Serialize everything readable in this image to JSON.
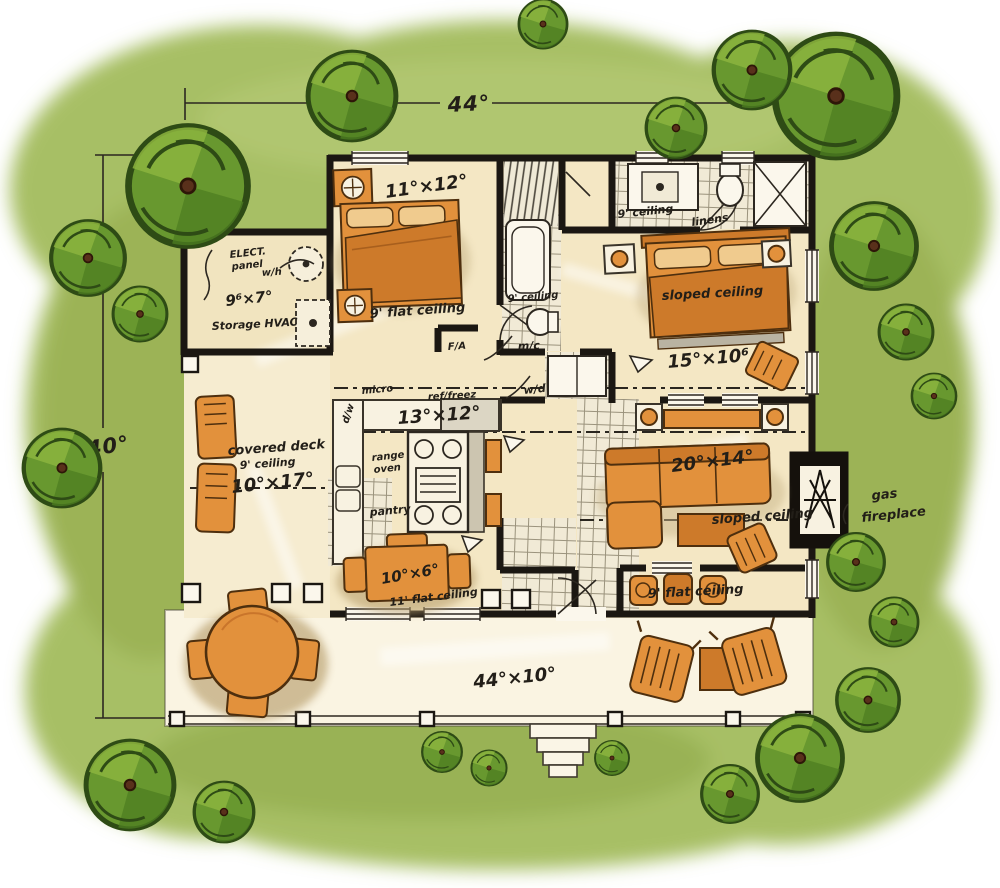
{
  "title": "hand-drawn cottage floor plan",
  "colors": {
    "ground_green": "#a7bf65",
    "tree_green": "#68982f",
    "floor_beige": "#f4e7c4",
    "porch_cream": "#faf4e2",
    "furniture_orange": "#e2913c",
    "wall_black": "#1b1712",
    "ink": "#221e18"
  },
  "dimensions": {
    "overall_width": "44°",
    "overall_depth": "40°"
  },
  "rooms": {
    "bedroom2": {
      "size": "11°×12°",
      "ceiling": "9' flat ceiling"
    },
    "storage": {
      "name": "Storage HVAC",
      "size": "9⁶×7°",
      "elect_line1": "ELECT.",
      "elect_line2": "panel",
      "water_heater": "w/h"
    },
    "bath": {
      "ceiling": "9' ceiling",
      "medicine_cabinet": "m/c",
      "washer_dryer": "w/d",
      "forced_air": "F/A"
    },
    "master_bath": {
      "ceiling": "9' ceiling",
      "linens": "linens"
    },
    "master_bedroom": {
      "ceiling": "sloped ceiling",
      "size": "15°×10⁶"
    },
    "kitchen": {
      "size": "13°×12°",
      "micro": "micro",
      "fridge": "ref/freez",
      "range_line1": "range",
      "range_line2": "oven",
      "dishwasher": "d/w",
      "pantry": "pantry"
    },
    "covered_deck": {
      "name": "covered deck",
      "ceiling": "9' ceiling",
      "size": "10°×17°"
    },
    "living": {
      "size": "20°×14°",
      "ceiling": "sloped ceiling",
      "flat_ceiling": "9' flat ceiling",
      "fireplace_line1": "gas",
      "fireplace_line2": "fireplace"
    },
    "dining": {
      "size": "10°×6°",
      "ceiling": "11' flat ceiling"
    },
    "porch": {
      "size": "44°×10°"
    }
  }
}
